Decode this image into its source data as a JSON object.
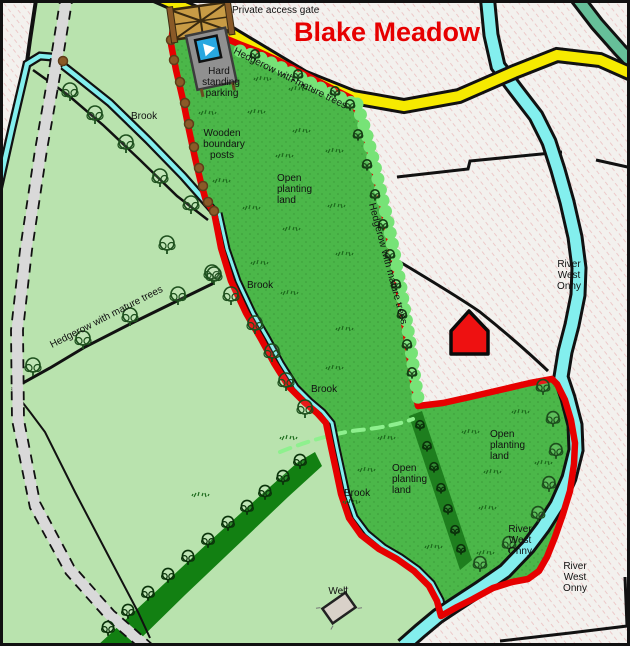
{
  "map": {
    "title": "Blake Meadow",
    "labels": {
      "private_access_gate": "Private access gate",
      "hard_standing": [
        "Hard",
        "standing",
        "parking"
      ],
      "hedgerow_top": "Hedgerow with mature trees",
      "hedgerow_east": "Hedgerow with mature trees",
      "hedgerow_west": "Hedgerow with mature trees",
      "wooden_posts": [
        "Wooden",
        "boundary",
        "posts"
      ],
      "brook_nw": "Brook",
      "brook_w1": "Brook",
      "brook_w2": "Brook",
      "brook_s": "Brook",
      "open_planting_north": [
        "Open",
        "planting",
        "land"
      ],
      "open_planting_south": [
        "Open",
        "planting",
        "land"
      ],
      "open_planting_se": [
        "Open",
        "planting",
        "land"
      ],
      "river_ne": [
        "River",
        "West",
        "Onny"
      ],
      "river_se_inner": [
        "River",
        "West",
        "Onny"
      ],
      "river_se_outer": [
        "River",
        "West",
        "Onny"
      ],
      "well": "Well"
    },
    "icons": {
      "gate": "field-gate-icon",
      "parking": "parking-waymark-icon",
      "house": "house-icon",
      "well": "well-icon",
      "tree": "tree-icon",
      "post": "boundary-post-icon",
      "tuft": "grass-tuft-icon"
    },
    "colors": {
      "background": "#f3f1ee",
      "hatch_pink": "#eabcbc",
      "field_light_green": "#b9e3ae",
      "meadow_green": "#4bb749",
      "meadow_dot": "#3b9a39",
      "woodland_green": "#128012",
      "strip_green": "#1e7e1e",
      "hedge_green": "#77e377",
      "boundary_red": "#e60000",
      "road_yellow": "#f6ea00",
      "river_cyan": "#83efee",
      "stream_teal": "#66bf99",
      "track_gray": "#d9d9d9",
      "post_brown": "#8a5a28",
      "tree_outline": "#1d4f1d",
      "house_red": "#ee1111",
      "title_red": "#e60000",
      "gate_tan": "#c89b45",
      "pad_gray": "#909090",
      "waymark_blue": "#28a7e0",
      "well_gray": "#d9d1c9"
    },
    "decor": {
      "posts": [
        [
          174,
          20
        ],
        [
          171,
          40
        ],
        [
          174,
          60
        ],
        [
          180,
          82
        ],
        [
          185,
          103
        ],
        [
          189,
          124
        ],
        [
          194,
          147
        ],
        [
          199,
          168
        ],
        [
          203,
          186
        ],
        [
          208,
          202
        ],
        [
          214,
          211
        ],
        [
          63,
          61
        ]
      ],
      "tufts": [
        [
          207,
          113
        ],
        [
          262,
          79
        ],
        [
          297,
          89
        ],
        [
          256,
          112
        ],
        [
          301,
          131
        ],
        [
          221,
          181
        ],
        [
          334,
          151
        ],
        [
          284,
          156
        ],
        [
          251,
          208
        ],
        [
          336,
          206
        ],
        [
          291,
          229
        ],
        [
          344,
          254
        ],
        [
          259,
          263
        ],
        [
          289,
          293
        ],
        [
          344,
          329
        ],
        [
          334,
          368
        ],
        [
          288,
          438
        ],
        [
          386,
          438
        ],
        [
          366,
          470
        ],
        [
          351,
          502
        ],
        [
          470,
          432
        ],
        [
          543,
          463
        ],
        [
          492,
          472
        ],
        [
          487,
          508
        ],
        [
          433,
          547
        ],
        [
          485,
          553
        ],
        [
          520,
          412
        ],
        [
          200,
          495
        ]
      ],
      "trees": {
        "field": [
          [
            70,
            100
          ],
          [
            95,
            123
          ],
          [
            126,
            152
          ],
          [
            160,
            186
          ],
          [
            191,
            213
          ],
          [
            212,
            282
          ],
          [
            231,
            304
          ],
          [
            255,
            333
          ],
          [
            272,
            361
          ],
          [
            286,
            390
          ],
          [
            305,
            417
          ],
          [
            33,
            375
          ],
          [
            83,
            348
          ],
          [
            130,
            325
          ],
          [
            178,
            304
          ],
          [
            214,
            284
          ],
          [
            167,
            253
          ]
        ],
        "river": [
          [
            543,
            394
          ],
          [
            553,
            426
          ],
          [
            556,
            458
          ],
          [
            549,
            491
          ],
          [
            538,
            521
          ],
          [
            509,
            551
          ],
          [
            480,
            571
          ]
        ],
        "hedge_small": [
          [
            350,
            110
          ],
          [
            358,
            140
          ],
          [
            367,
            170
          ],
          [
            375,
            200
          ],
          [
            383,
            230
          ],
          [
            390,
            260
          ],
          [
            396,
            290
          ],
          [
            402,
            320
          ],
          [
            407,
            350
          ],
          [
            412,
            378
          ],
          [
            255,
            60
          ],
          [
            298,
            80
          ],
          [
            335,
            97
          ]
        ],
        "wood": [
          [
            300,
            468
          ],
          [
            283,
            484
          ],
          [
            265,
            499
          ],
          [
            247,
            514
          ],
          [
            228,
            530
          ],
          [
            208,
            547
          ],
          [
            188,
            564
          ],
          [
            168,
            582
          ],
          [
            148,
            600
          ],
          [
            128,
            618
          ],
          [
            108,
            635
          ]
        ],
        "strip": [
          [
            420,
            430
          ],
          [
            427,
            451
          ],
          [
            434,
            472
          ],
          [
            441,
            493
          ],
          [
            448,
            514
          ],
          [
            455,
            535
          ],
          [
            461,
            554
          ]
        ]
      }
    }
  }
}
